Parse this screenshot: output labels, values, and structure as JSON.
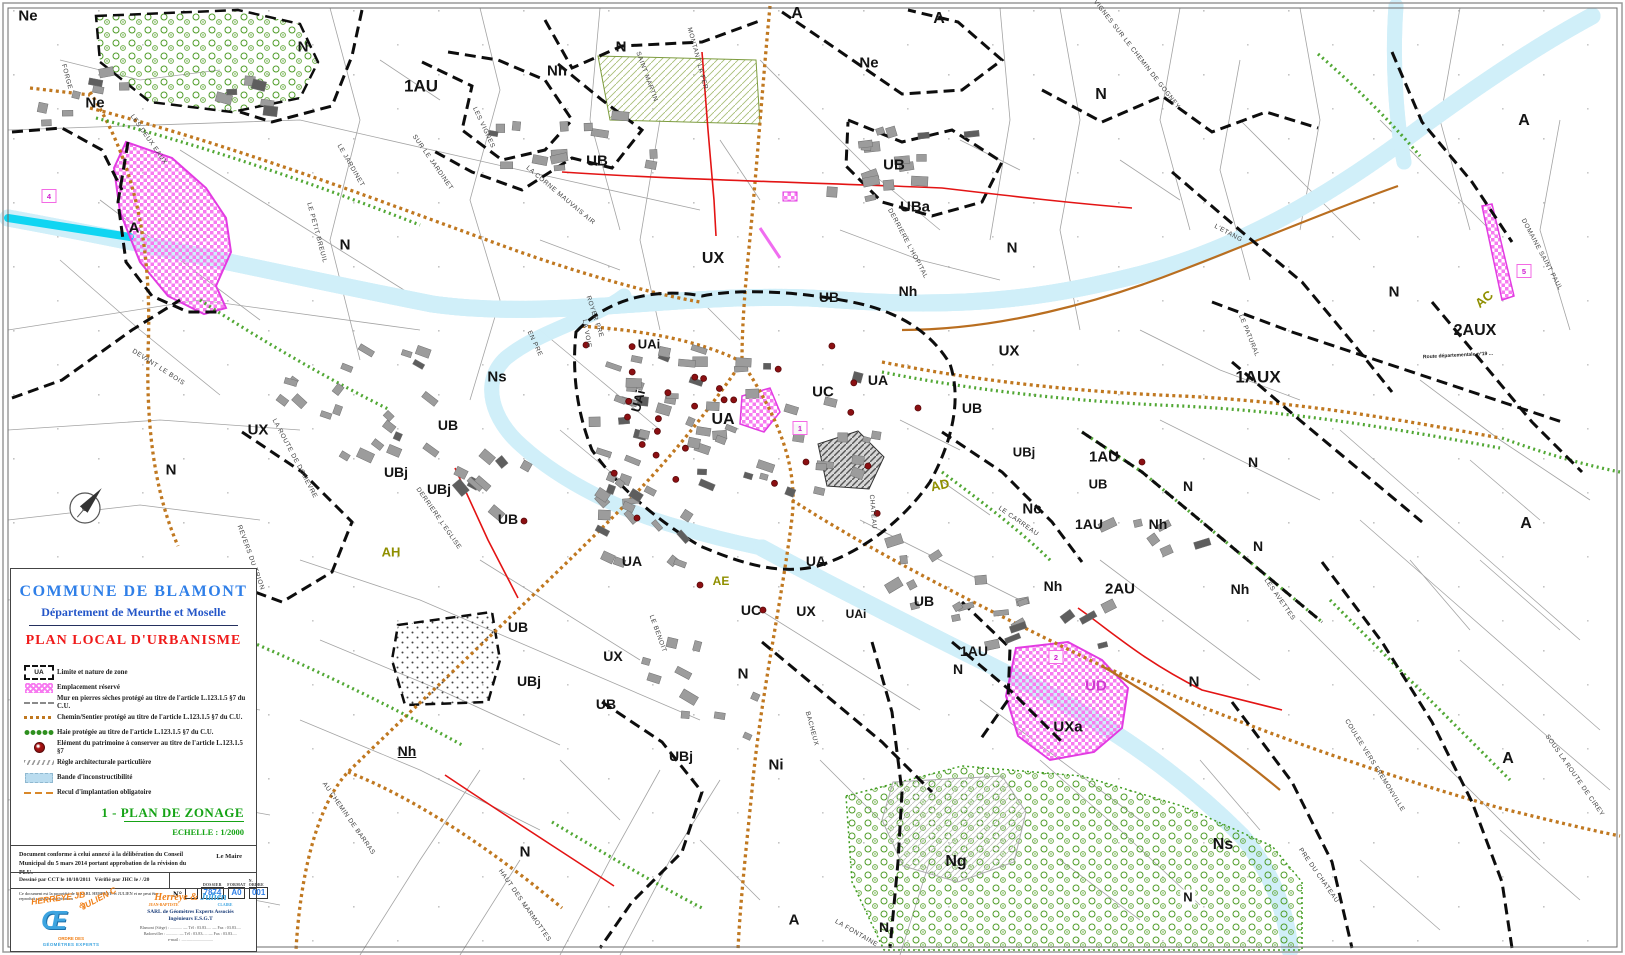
{
  "panel": {
    "commune": "COMMUNE DE BLAMONT",
    "departement": "Département de  Meurthe et Moselle",
    "plan_title": "PLAN LOCAL D'URBANISME",
    "legend_items": [
      {
        "symbol": "zone-limit",
        "symbol_text": "UA",
        "label": "Limite et nature de zone"
      },
      {
        "symbol": "pink-hatch",
        "label": "Emplacement réservé"
      },
      {
        "symbol": "wall-line",
        "label": "Mur en pierres sèches protégé au titre de l'article L.123.1.5 §7 du C.U."
      },
      {
        "symbol": "path-line",
        "label": "Chemin/Sentier protégé au titre de l'article L.123.1.5 §7 du C.U."
      },
      {
        "symbol": "hedge-line",
        "label": "Haie protégée au titre de l'article L.123.1.5 §7 du C.U."
      },
      {
        "symbol": "heritage-dot",
        "label": "Elément du patrimoine à conserver au titre de l'article L.123.1.5 §7"
      },
      {
        "symbol": "arch-rule",
        "label": "Règle architecturale particulière"
      },
      {
        "symbol": "blue-band",
        "label": "Bande d'inconstructibilité"
      },
      {
        "symbol": "setback-line",
        "label": "Recul d'implantation obligatoire"
      }
    ],
    "zonage_title": "1 - PLAN DE ZONAGE",
    "echelle": "ECHELLE : 1/2000",
    "approval_text": "Document conforme à celui annexé à la délibération du Conseil Municipal du 5 mars 2014 portant approbation de la révision du PLU.",
    "le_maire": "Le Maire",
    "drawn_by": "Dessiné par  CCT le 10/10/2011",
    "verified_by": "Vérifié par  JHC le    /    /20",
    "property_note": "Ce document est la propriété de la SARL HERREYE et JULIEN et ne peut être reproduit sans son autorisation",
    "number_label": "N°",
    "dossier_label": "DOSSIER",
    "dossier_value": "7874",
    "format_label": "FORMAT",
    "format_value": "A0",
    "ordre_label": "N. ORDRE",
    "ordre_value": "001",
    "logo_line1": "HERREYE JB",
    "logo_amp": "&",
    "logo_line2": "JULIEN C",
    "logo_glyph": "Œ",
    "logo_sub1": "ORDRE DES",
    "logo_sub2": "GÉOMÈTRES EXPERTS",
    "company_name_1": "Herreye",
    "company_amp": " & ",
    "company_name_2": "Julien",
    "company_sub_1": "JEAN-BAPTISTE",
    "company_sub_2": "CLAIRE",
    "company_line1": "SARL de Géomètres Experts Associés",
    "company_line2": "Ingénieurs E.S.G.T",
    "company_addr1": "Blamont (Siège) : ............ — Tél : 03.83..... — Fax : 03.83.....",
    "company_addr2": "Badonviller : ............ — Tél : 03.83..... — Fax : 03.83.....",
    "company_addr3": "e-mail : ..............................."
  },
  "map": {
    "colors": {
      "zone_label": "#141414",
      "olive": "#8f8f00",
      "pink_zone": "#cf3ccf",
      "river": "#10d5f2",
      "band": "#cfeef8",
      "path_orange": "#c07820",
      "boundary_black": "#0d0d0d",
      "reserve_pink": "#f77bf0",
      "heritage_red": "#8b0f12"
    },
    "zone_labels": [
      {
        "t": "Ne",
        "x": 28,
        "y": 16,
        "s": 15
      },
      {
        "t": "Ne",
        "x": 95,
        "y": 103,
        "s": 15
      },
      {
        "t": "N",
        "x": 303,
        "y": 47,
        "s": 15
      },
      {
        "t": "1AU",
        "x": 421,
        "y": 86,
        "s": 17
      },
      {
        "t": "Nh",
        "x": 557,
        "y": 71,
        "s": 15
      },
      {
        "t": "N",
        "x": 621,
        "y": 47,
        "s": 15
      },
      {
        "t": "A",
        "x": 797,
        "y": 14,
        "s": 16
      },
      {
        "t": "Ne",
        "x": 869,
        "y": 63,
        "s": 15
      },
      {
        "t": "A",
        "x": 939,
        "y": 19,
        "s": 16
      },
      {
        "t": "N",
        "x": 1101,
        "y": 95,
        "s": 16
      },
      {
        "t": "A",
        "x": 1524,
        "y": 121,
        "s": 16
      },
      {
        "t": "UB",
        "x": 597,
        "y": 161,
        "s": 15
      },
      {
        "t": "UB",
        "x": 894,
        "y": 165,
        "s": 15
      },
      {
        "t": "UBa",
        "x": 915,
        "y": 207,
        "s": 15
      },
      {
        "t": "UX",
        "x": 713,
        "y": 259,
        "s": 16
      },
      {
        "t": "N",
        "x": 1012,
        "y": 248,
        "s": 15
      },
      {
        "t": "Nh",
        "x": 908,
        "y": 291,
        "s": 14
      },
      {
        "t": "UB",
        "x": 829,
        "y": 297,
        "s": 14
      },
      {
        "t": "N",
        "x": 345,
        "y": 245,
        "s": 15
      },
      {
        "t": "A",
        "x": 134,
        "y": 228,
        "s": 15
      },
      {
        "t": "Ns",
        "x": 497,
        "y": 377,
        "s": 15
      },
      {
        "t": "UAi",
        "x": 649,
        "y": 344,
        "s": 13
      },
      {
        "t": "UAi",
        "x": 638,
        "y": 401,
        "s": 13,
        "r": -75
      },
      {
        "t": "UA",
        "x": 723,
        "y": 420,
        "s": 16
      },
      {
        "t": "UC",
        "x": 823,
        "y": 392,
        "s": 15
      },
      {
        "t": "UA",
        "x": 878,
        "y": 380,
        "s": 14
      },
      {
        "t": "UB",
        "x": 972,
        "y": 408,
        "s": 14
      },
      {
        "t": "UBj",
        "x": 1024,
        "y": 452,
        "s": 13
      },
      {
        "t": "1AU",
        "x": 1104,
        "y": 457,
        "s": 15
      },
      {
        "t": "UB",
        "x": 1098,
        "y": 484,
        "s": 13
      },
      {
        "t": "Nc",
        "x": 1032,
        "y": 509,
        "s": 15
      },
      {
        "t": "1AU",
        "x": 1089,
        "y": 524,
        "s": 14
      },
      {
        "t": "Nh",
        "x": 1158,
        "y": 524,
        "s": 14
      },
      {
        "t": "Nh",
        "x": 1053,
        "y": 586,
        "s": 14
      },
      {
        "t": "2AU",
        "x": 1120,
        "y": 589,
        "s": 15
      },
      {
        "t": "Nh",
        "x": 1240,
        "y": 589,
        "s": 14
      },
      {
        "t": "N",
        "x": 1253,
        "y": 462,
        "s": 14
      },
      {
        "t": "N",
        "x": 1188,
        "y": 486,
        "s": 14
      },
      {
        "t": "N",
        "x": 1258,
        "y": 546,
        "s": 14
      },
      {
        "t": "AD",
        "x": 940,
        "y": 485,
        "s": 13,
        "c": "olive",
        "r": -12
      },
      {
        "t": "UX",
        "x": 1009,
        "y": 351,
        "s": 15
      },
      {
        "t": "UX",
        "x": 258,
        "y": 430,
        "s": 15
      },
      {
        "t": "N",
        "x": 171,
        "y": 470,
        "s": 15
      },
      {
        "t": "UB",
        "x": 448,
        "y": 425,
        "s": 14
      },
      {
        "t": "UBj",
        "x": 396,
        "y": 472,
        "s": 14
      },
      {
        "t": "UBj",
        "x": 439,
        "y": 489,
        "s": 14
      },
      {
        "t": "UB",
        "x": 508,
        "y": 519,
        "s": 14
      },
      {
        "t": "AH",
        "x": 391,
        "y": 552,
        "s": 13,
        "c": "olive"
      },
      {
        "t": "UB",
        "x": 518,
        "y": 627,
        "s": 14
      },
      {
        "t": "UBj",
        "x": 529,
        "y": 681,
        "s": 14
      },
      {
        "t": "Nh",
        "x": 407,
        "y": 751,
        "s": 14,
        "u": 1
      },
      {
        "t": "N",
        "x": 525,
        "y": 852,
        "s": 15
      },
      {
        "t": "UA",
        "x": 632,
        "y": 561,
        "s": 14
      },
      {
        "t": "UA",
        "x": 816,
        "y": 561,
        "s": 14
      },
      {
        "t": "AE",
        "x": 721,
        "y": 581,
        "s": 12,
        "c": "olive"
      },
      {
        "t": "UC",
        "x": 751,
        "y": 610,
        "s": 14
      },
      {
        "t": "UX",
        "x": 806,
        "y": 611,
        "s": 14
      },
      {
        "t": "UAi",
        "x": 856,
        "y": 614,
        "s": 12
      },
      {
        "t": "UB",
        "x": 924,
        "y": 601,
        "s": 14
      },
      {
        "t": "UX",
        "x": 613,
        "y": 656,
        "s": 14
      },
      {
        "t": "UB",
        "x": 606,
        "y": 704,
        "s": 14
      },
      {
        "t": "UBj",
        "x": 681,
        "y": 756,
        "s": 14
      },
      {
        "t": "N",
        "x": 743,
        "y": 674,
        "s": 15
      },
      {
        "t": "Ni",
        "x": 776,
        "y": 765,
        "s": 15
      },
      {
        "t": "1AU",
        "x": 974,
        "y": 651,
        "s": 14
      },
      {
        "t": "N",
        "x": 958,
        "y": 669,
        "s": 14
      },
      {
        "t": "UD",
        "x": 1096,
        "y": 686,
        "s": 15,
        "c": "pink"
      },
      {
        "t": "UXa",
        "x": 1068,
        "y": 727,
        "s": 15
      },
      {
        "t": "N",
        "x": 1194,
        "y": 682,
        "s": 15
      },
      {
        "t": "Ns",
        "x": 1223,
        "y": 845,
        "s": 16
      },
      {
        "t": "N",
        "x": 1188,
        "y": 897,
        "s": 13,
        "bg": 1
      },
      {
        "t": "Ng",
        "x": 956,
        "y": 862,
        "s": 16
      },
      {
        "t": "A",
        "x": 794,
        "y": 920,
        "s": 15
      },
      {
        "t": "N",
        "x": 884,
        "y": 927,
        "s": 14
      },
      {
        "t": "AC",
        "x": 1484,
        "y": 299,
        "s": 13,
        "c": "olive",
        "r": -40
      },
      {
        "t": "2AUX",
        "x": 1475,
        "y": 331,
        "s": 16
      },
      {
        "t": "1AUX",
        "x": 1258,
        "y": 377,
        "s": 17
      },
      {
        "t": "N",
        "x": 1394,
        "y": 292,
        "s": 15
      },
      {
        "t": "A",
        "x": 1526,
        "y": 524,
        "s": 16
      },
      {
        "t": "A",
        "x": 1508,
        "y": 759,
        "s": 16
      }
    ],
    "street_labels": [
      {
        "t": "FORGE",
        "x": 66,
        "y": 77,
        "r": 75
      },
      {
        "t": "LES DEUX EAUX",
        "x": 148,
        "y": 140,
        "r": 55
      },
      {
        "t": "LE JARDINET",
        "x": 350,
        "y": 166,
        "r": 60
      },
      {
        "t": "SUR LE JARDINET",
        "x": 432,
        "y": 163,
        "r": 55
      },
      {
        "t": "LES VIGNES",
        "x": 483,
        "y": 128,
        "r": 65
      },
      {
        "t": "LE PETIT BREUIL",
        "x": 316,
        "y": 233,
        "r": 75
      },
      {
        "t": "MONTANT LA FER.",
        "x": 697,
        "y": 60,
        "r": 75
      },
      {
        "t": "SAINT MARTIN",
        "x": 646,
        "y": 77,
        "r": 70
      },
      {
        "t": "LA CORNE MAUVAIS AIR",
        "x": 560,
        "y": 196,
        "r": 40
      },
      {
        "t": "DERRIERE L'HOPITAL",
        "x": 907,
        "y": 244,
        "r": 62
      },
      {
        "t": "VIGNES SUR LE CHEMIN DE GOGNEY",
        "x": 1136,
        "y": 55,
        "r": 52
      },
      {
        "t": "L'ETANG",
        "x": 1228,
        "y": 234,
        "r": 28
      },
      {
        "t": "DOMAINE SAINT PAUL",
        "x": 1541,
        "y": 255,
        "r": 62
      },
      {
        "t": "LE PATURAL",
        "x": 1248,
        "y": 336,
        "r": 68
      },
      {
        "t": "LE CARREAU",
        "x": 1018,
        "y": 522,
        "r": 35
      },
      {
        "t": "LES AVETTES",
        "x": 1279,
        "y": 600,
        "r": 55
      },
      {
        "t": "DEVANT LE BOIS",
        "x": 158,
        "y": 368,
        "r": 33
      },
      {
        "t": "LA ROUTE DE DOMEVRE",
        "x": 294,
        "y": 459,
        "r": 62
      },
      {
        "t": "REVERS DU TRION",
        "x": 250,
        "y": 558,
        "r": 70
      },
      {
        "t": "DERRIERE L'EGLISE",
        "x": 438,
        "y": 519,
        "r": 55
      },
      {
        "t": "AU CHEMIN DE BARRAS",
        "x": 348,
        "y": 819,
        "r": 55
      },
      {
        "t": "HAUT DES MARMOTTES",
        "x": 524,
        "y": 906,
        "r": 55
      },
      {
        "t": "LA FONTAINE",
        "x": 856,
        "y": 934,
        "r": 30
      },
      {
        "t": "PRE DU CHATEAU",
        "x": 1318,
        "y": 876,
        "r": 55
      },
      {
        "t": "COULEE VERS FREMONVILLE",
        "x": 1374,
        "y": 766,
        "r": 58
      },
      {
        "t": "SOUS LA ROUTE DE CIREY",
        "x": 1574,
        "y": 776,
        "r": 55
      },
      {
        "t": "CHATEAU",
        "x": 872,
        "y": 512,
        "r": 85
      },
      {
        "t": "LE BENOIT",
        "x": 657,
        "y": 634,
        "r": 70
      },
      {
        "t": "BACHEUX",
        "x": 811,
        "y": 729,
        "r": 75
      },
      {
        "t": "LA VOIE",
        "x": 586,
        "y": 334,
        "r": 80
      },
      {
        "t": "ROYER PRE",
        "x": 594,
        "y": 317,
        "r": 72
      },
      {
        "t": "EN PRE",
        "x": 534,
        "y": 344,
        "r": 65
      }
    ],
    "road_labels": [
      {
        "t": "Route départementale n°19 ...",
        "x": 1458,
        "y": 356,
        "r": -3
      }
    ],
    "markers": [
      {
        "n": "4",
        "x": 49,
        "y": 196
      },
      {
        "n": "1",
        "x": 800,
        "y": 428
      },
      {
        "n": "5",
        "x": 1524,
        "y": 271
      },
      {
        "n": "2",
        "x": 1056,
        "y": 657
      }
    ]
  }
}
